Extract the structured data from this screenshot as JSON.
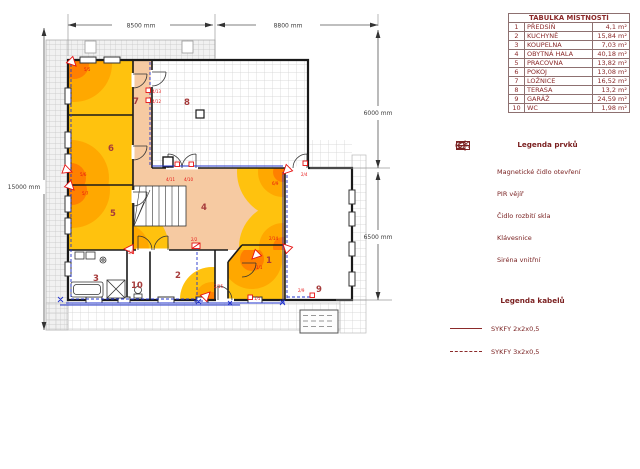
{
  "room_table": {
    "title": "TABULKA MÍSTNOSTÍ",
    "rows": [
      {
        "num": "1",
        "name": "PŘEDSÍŇ",
        "area": "4,1 m²"
      },
      {
        "num": "2",
        "name": "KUCHYNĚ",
        "area": "15,84 m²"
      },
      {
        "num": "3",
        "name": "KOUPELNA",
        "area": "7,03 m²"
      },
      {
        "num": "4",
        "name": "OBYTNÁ HALA",
        "area": "40,18 m²"
      },
      {
        "num": "5",
        "name": "PRACOVNA",
        "area": "13,82 m²"
      },
      {
        "num": "6",
        "name": "POKOJ",
        "area": "13,08 m²"
      },
      {
        "num": "7",
        "name": "LOŽNICE",
        "area": "16,52 m²"
      },
      {
        "num": "8",
        "name": "TERASA",
        "area": "13,2 m²"
      },
      {
        "num": "9",
        "name": "GARÁŽ",
        "area": "24,59 m²"
      },
      {
        "num": "10",
        "name": "WC",
        "area": "1,98 m²"
      }
    ]
  },
  "legend_elements": {
    "title": "Legenda prvků",
    "items": [
      {
        "icon": "magnetic-contact",
        "label": "Magnetické čidlo otevření"
      },
      {
        "icon": "pir-fan",
        "label": "PIR vějíř"
      },
      {
        "icon": "glass-break",
        "label": "Čidlo rozbití skla"
      },
      {
        "icon": "keypad",
        "label": "Klávesnice"
      },
      {
        "icon": "siren",
        "label": "Siréna vnitřní"
      }
    ]
  },
  "legend_cables": {
    "title": "Legenda kabelů",
    "items": [
      {
        "style": "solid",
        "label": "SYKFY 2x2x0,5"
      },
      {
        "style": "dashed",
        "label": "SYKFY 3x2x0,5"
      }
    ]
  },
  "dimensions": {
    "top_left": "8500 mm",
    "top_right": "8800 mm",
    "left": "15000 mm",
    "right_top": "6000 mm",
    "right_bottom": "6500 mm"
  },
  "plan": {
    "colors": {
      "pir_inner": "#ff8000",
      "pir_mid": "#ffa800",
      "pir_outer": "#ffc20e",
      "room_base": "#f6caa2",
      "cable_blue": "#2233cc",
      "sensor_red": "#e61010",
      "label_maroon": "#a63b3b"
    },
    "sensors": [
      {
        "type": "magnetic",
        "label": "4/13"
      },
      {
        "type": "magnetic",
        "label": "4/12"
      },
      {
        "type": "magnetic",
        "label": "4/11"
      },
      {
        "type": "magnetic",
        "label": "4/10"
      },
      {
        "type": "magnetic",
        "label": "2/4"
      },
      {
        "type": "magnetic",
        "label": "2/9"
      },
      {
        "type": "magnetic",
        "label": "1/5"
      },
      {
        "type": "pir",
        "label": "5/5"
      },
      {
        "type": "pir",
        "label": "5/6"
      },
      {
        "type": "pir",
        "label": "5/7"
      },
      {
        "type": "pir",
        "label": "5/8"
      },
      {
        "type": "pir",
        "label": "6/9"
      },
      {
        "type": "pir",
        "label": "2/14"
      },
      {
        "type": "pir",
        "label": "1/1"
      },
      {
        "type": "pir",
        "label": "2/15"
      },
      {
        "type": "keypad",
        "label": "2/2"
      }
    ]
  }
}
